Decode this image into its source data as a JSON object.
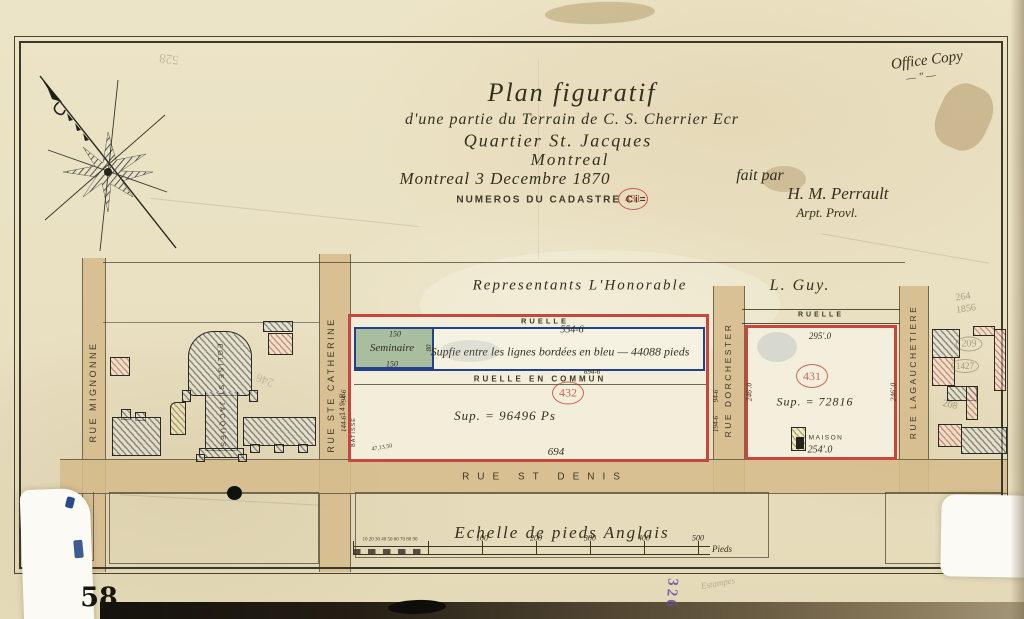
{
  "document": {
    "office_copy": "Office Copy",
    "office_copy_mark": "—  ″  —",
    "archive_number": "58",
    "purple_number": "326",
    "pencil_top_left": "528",
    "pencil_mid_left": "246",
    "pencil_estampes": "Estampes"
  },
  "title_block": {
    "line1": "Plan figuratif",
    "line2": "d'une partie du Terrain de C. S. Cherrier Ecr",
    "line3": "Quartier St. Jacques",
    "line4": "Montreal",
    "dateline": "Montreal 3 Decembre 1870",
    "cadastre_label": "NUMEROS DU CADASTRE Ci=",
    "cadastre_number": "431",
    "fait_par": "fait par",
    "surveyor_name": "H. M. Perrault",
    "surveyor_title": "Arpt. Provl."
  },
  "heading": {
    "representants": "Representants L'Honorable",
    "owner": "L. Guy."
  },
  "streets": {
    "mignonne": "RUE MIGNONNE",
    "ste_catherine": "RUE STE CATHERINE",
    "ste_catherine_pencil": "149 R",
    "dorchester": "RUE DORCHESTER",
    "lagauchetiere": "RUE LAGAUCHETIERE",
    "st_denis": "RUE ST DENIS"
  },
  "lanes": {
    "ruelle_432": "RUELLE",
    "ruelle_431": "RUELLE",
    "ruelle_commun": "RUELLE EN COMMUN",
    "ruelle_commun_measure": "694-6"
  },
  "church_label": "EGLISE ST JACQUES",
  "seminaire": {
    "label": "Seminaire",
    "top": "150",
    "bottom": "150",
    "right": "80"
  },
  "blue_area": {
    "top_measure": "554-6",
    "text": "Supfie entre les lignes bordées en bleu — 44088 pieds"
  },
  "lot432": {
    "number": "432",
    "sup": "Sup. = 96496 Ps",
    "bottom_measure": "694",
    "left_upper": "94-6",
    "left_lower": "144-6",
    "right_upper": "94-6",
    "right_lower": "194-6",
    "bearing": "47.13.50",
    "batisse": "BATISSE"
  },
  "lot431": {
    "number": "431",
    "top_measure": "295'.0",
    "sup": "Sup. = 72816",
    "left_measure": "246'.0",
    "right_measure": "246'.0",
    "bottom_measure": "254'.0",
    "maison": "MAISON"
  },
  "scale": {
    "title": "Echelle de pieds Anglais",
    "sub_numbers": "10 20 30 40 50 60 70 80 90",
    "ticks": [
      "100",
      "200",
      "300",
      "400",
      "500"
    ],
    "unit": "Pieds"
  },
  "pencil_marks": {
    "right_block_1": "264",
    "right_block_2": "1856",
    "right_block_3": "209",
    "right_block_4": "1427",
    "right_block_5": "208"
  },
  "colors": {
    "paper": "#e9e0c2",
    "street": "#d6bc8e",
    "lot_red": "#c6473e",
    "line_blue": "#23408c",
    "seminaire_green": "#a9bd9f",
    "stamp_red": "#c0392b",
    "ink": "#2e2b20",
    "purple": "#6b4d9e"
  }
}
